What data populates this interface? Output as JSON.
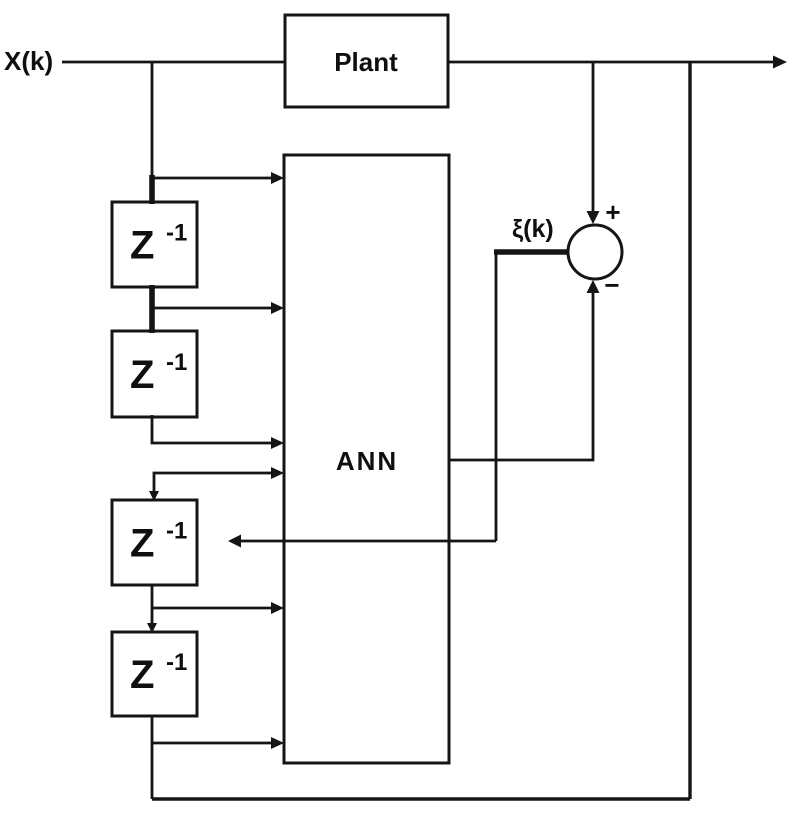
{
  "diagram": {
    "background_color": "#ffffff",
    "line_color": "#151515",
    "labels": {
      "input": "X(k)",
      "plant": "Plant",
      "ann": "ANN",
      "error": "ξ(k)",
      "sum_plus": "+",
      "sum_minus": "−"
    },
    "delay_blocks": [
      {
        "base": "Z",
        "exponent": "-1"
      },
      {
        "base": "Z",
        "exponent": "-1"
      },
      {
        "base": "Z",
        "exponent": "-1"
      },
      {
        "base": "Z",
        "exponent": "-1"
      }
    ]
  }
}
